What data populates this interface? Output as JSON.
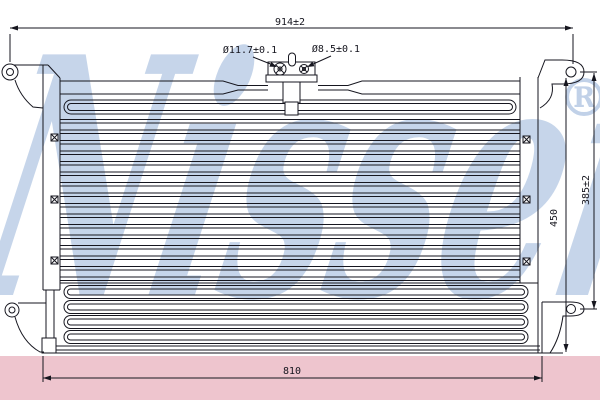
{
  "watermark": {
    "brand": "Nissens",
    "registered_mark": "®",
    "blue": "#8fadd6",
    "pink_band": "#eec5ce"
  },
  "drawing": {
    "line_color": "#16161f",
    "dimensions": {
      "overall_width": "914±2",
      "large_port_diameter": "Ø11.7±0.1",
      "small_port_diameter": "Ø8.5±0.1",
      "mount_height": "385±2",
      "body_height": "450",
      "lower_width": "810"
    }
  }
}
